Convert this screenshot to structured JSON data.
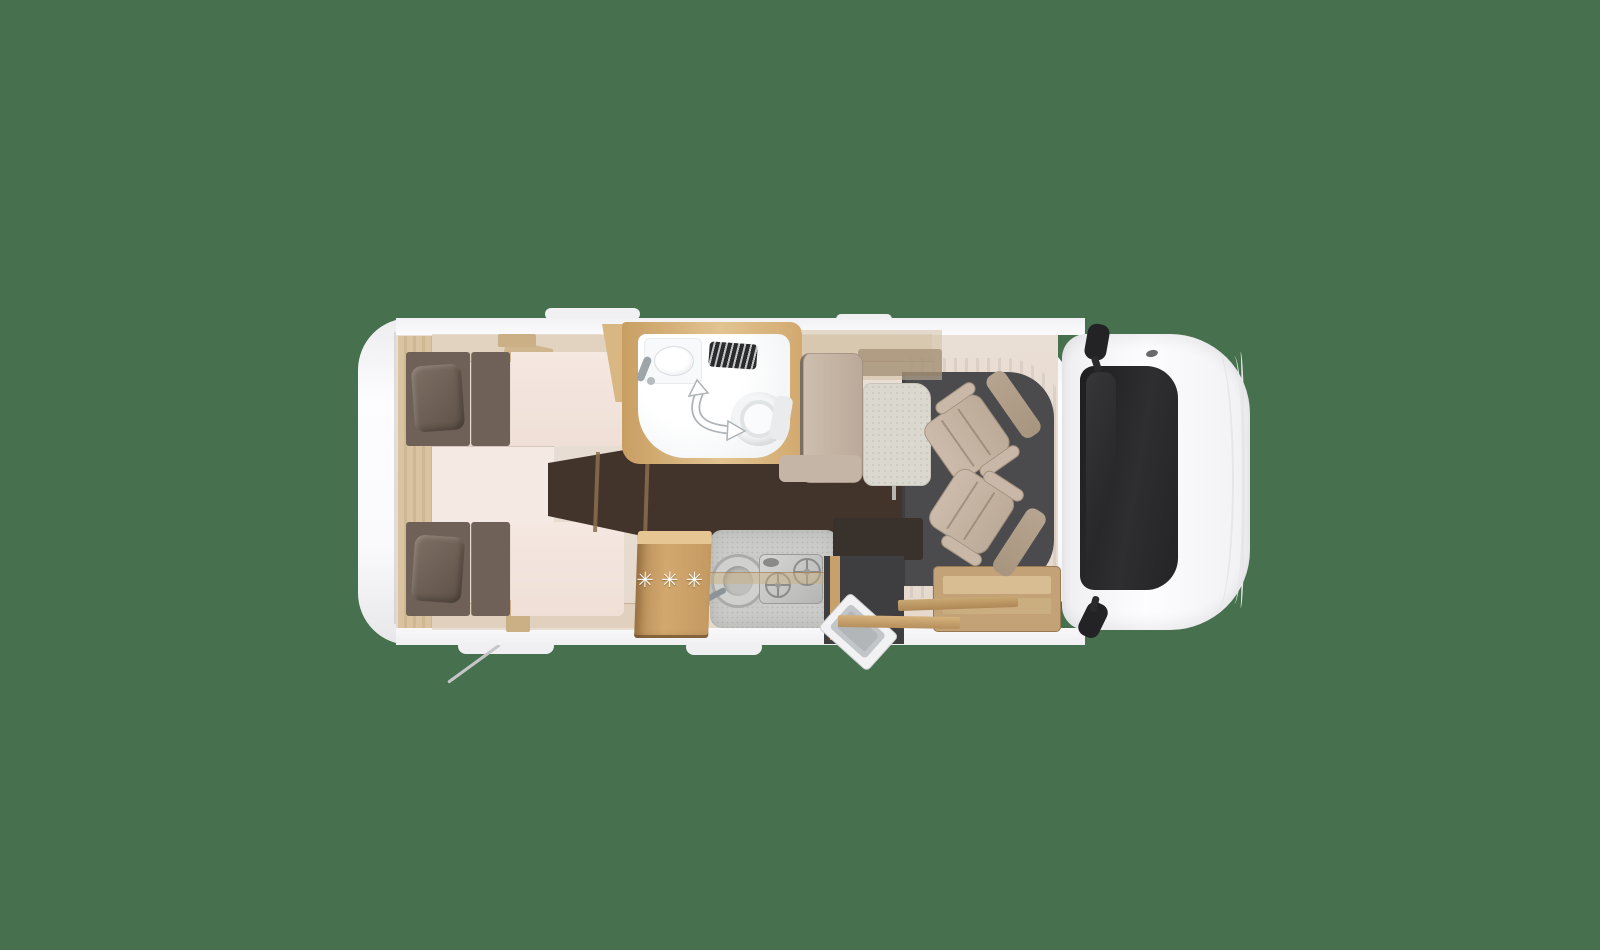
{
  "scene": {
    "subject": "motorhome-floorplan-top-view",
    "background": "#47704E"
  },
  "symbols": {
    "fridge_rating": "✳✳✳"
  },
  "icons": {
    "swivel_arrow": "curved-double-arrow-icon",
    "vent": "louver-grille-icon",
    "mirror_top": "side-mirror-icon",
    "mirror_bottom": "side-mirror-icon"
  },
  "colors": {
    "bg": "#47704E",
    "floor": "#EADFD5",
    "mattress": "#6F6158",
    "bed_pale": "#F5E8E1",
    "walkway": "#42342A",
    "wood": "#D3B083",
    "counter": "#CBCBC9",
    "table": "#DAD8CF",
    "cab_floor": "#4B4B4D",
    "seat": "#BDAB9A",
    "windshield": "#2E2E31",
    "shell": "#F6F6F8"
  }
}
